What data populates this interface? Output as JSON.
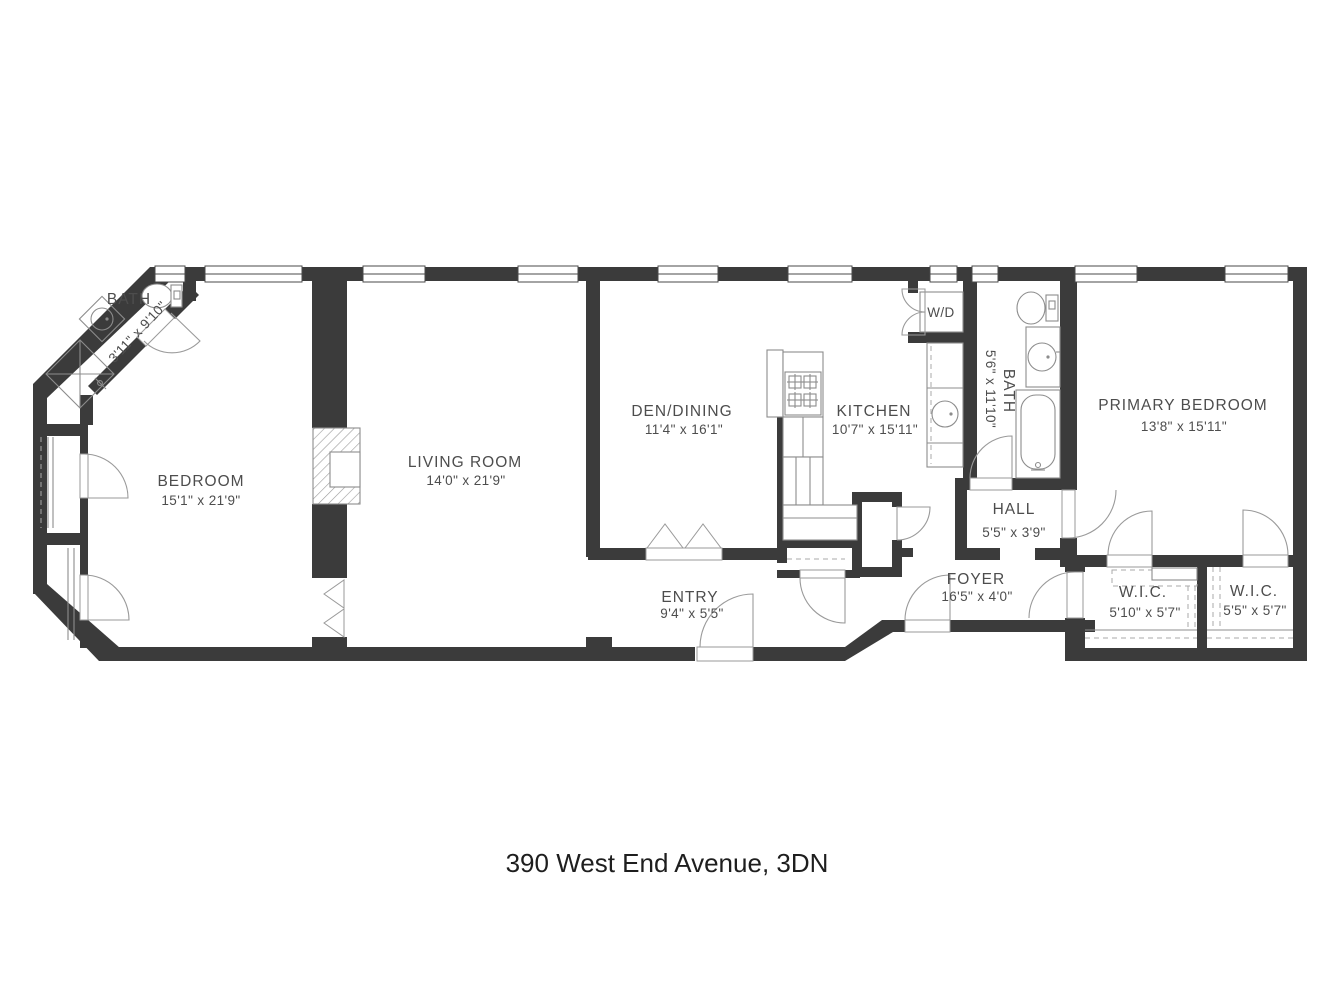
{
  "title": "390 West End Avenue, 3DN",
  "rooms": {
    "bath_small": {
      "name": "BATH",
      "dims": "3'11\" x 9'10\""
    },
    "bedroom": {
      "name": "BEDROOM",
      "dims": "15'1\" x 21'9\""
    },
    "living_room": {
      "name": "LIVING ROOM",
      "dims": "14'0\" x 21'9\""
    },
    "den_dining": {
      "name": "DEN/DINING",
      "dims": "11'4\" x 16'1\""
    },
    "kitchen": {
      "name": "KITCHEN",
      "dims": "10'7\" x 15'11\""
    },
    "laundry": {
      "name": "W/D"
    },
    "bath_primary": {
      "name": "BATH",
      "dims": "5'6\" x 11'10\""
    },
    "primary_bedroom": {
      "name": "PRIMARY BEDROOM",
      "dims": "13'8\" x 15'11\""
    },
    "hall": {
      "name": "HALL",
      "dims": "5'5\" x 3'9\""
    },
    "foyer": {
      "name": "FOYER",
      "dims": "16'5\" x 4'0\""
    },
    "entry": {
      "name": "ENTRY",
      "dims": "9'4\" x 5'5\""
    },
    "wic_left": {
      "name": "W.I.C.",
      "dims": "5'10\" x 5'7\""
    },
    "wic_right": {
      "name": "W.I.C.",
      "dims": "5'5\" x 5'7\""
    }
  },
  "colors": {
    "wall": "#3b3b3b",
    "fixture_line": "#8c8c8c",
    "door_line": "#9a9a9a",
    "window_line": "#4a4a4a",
    "label_text": "#4d4d4d",
    "title_text": "#1e1e1e",
    "background": "#ffffff"
  }
}
